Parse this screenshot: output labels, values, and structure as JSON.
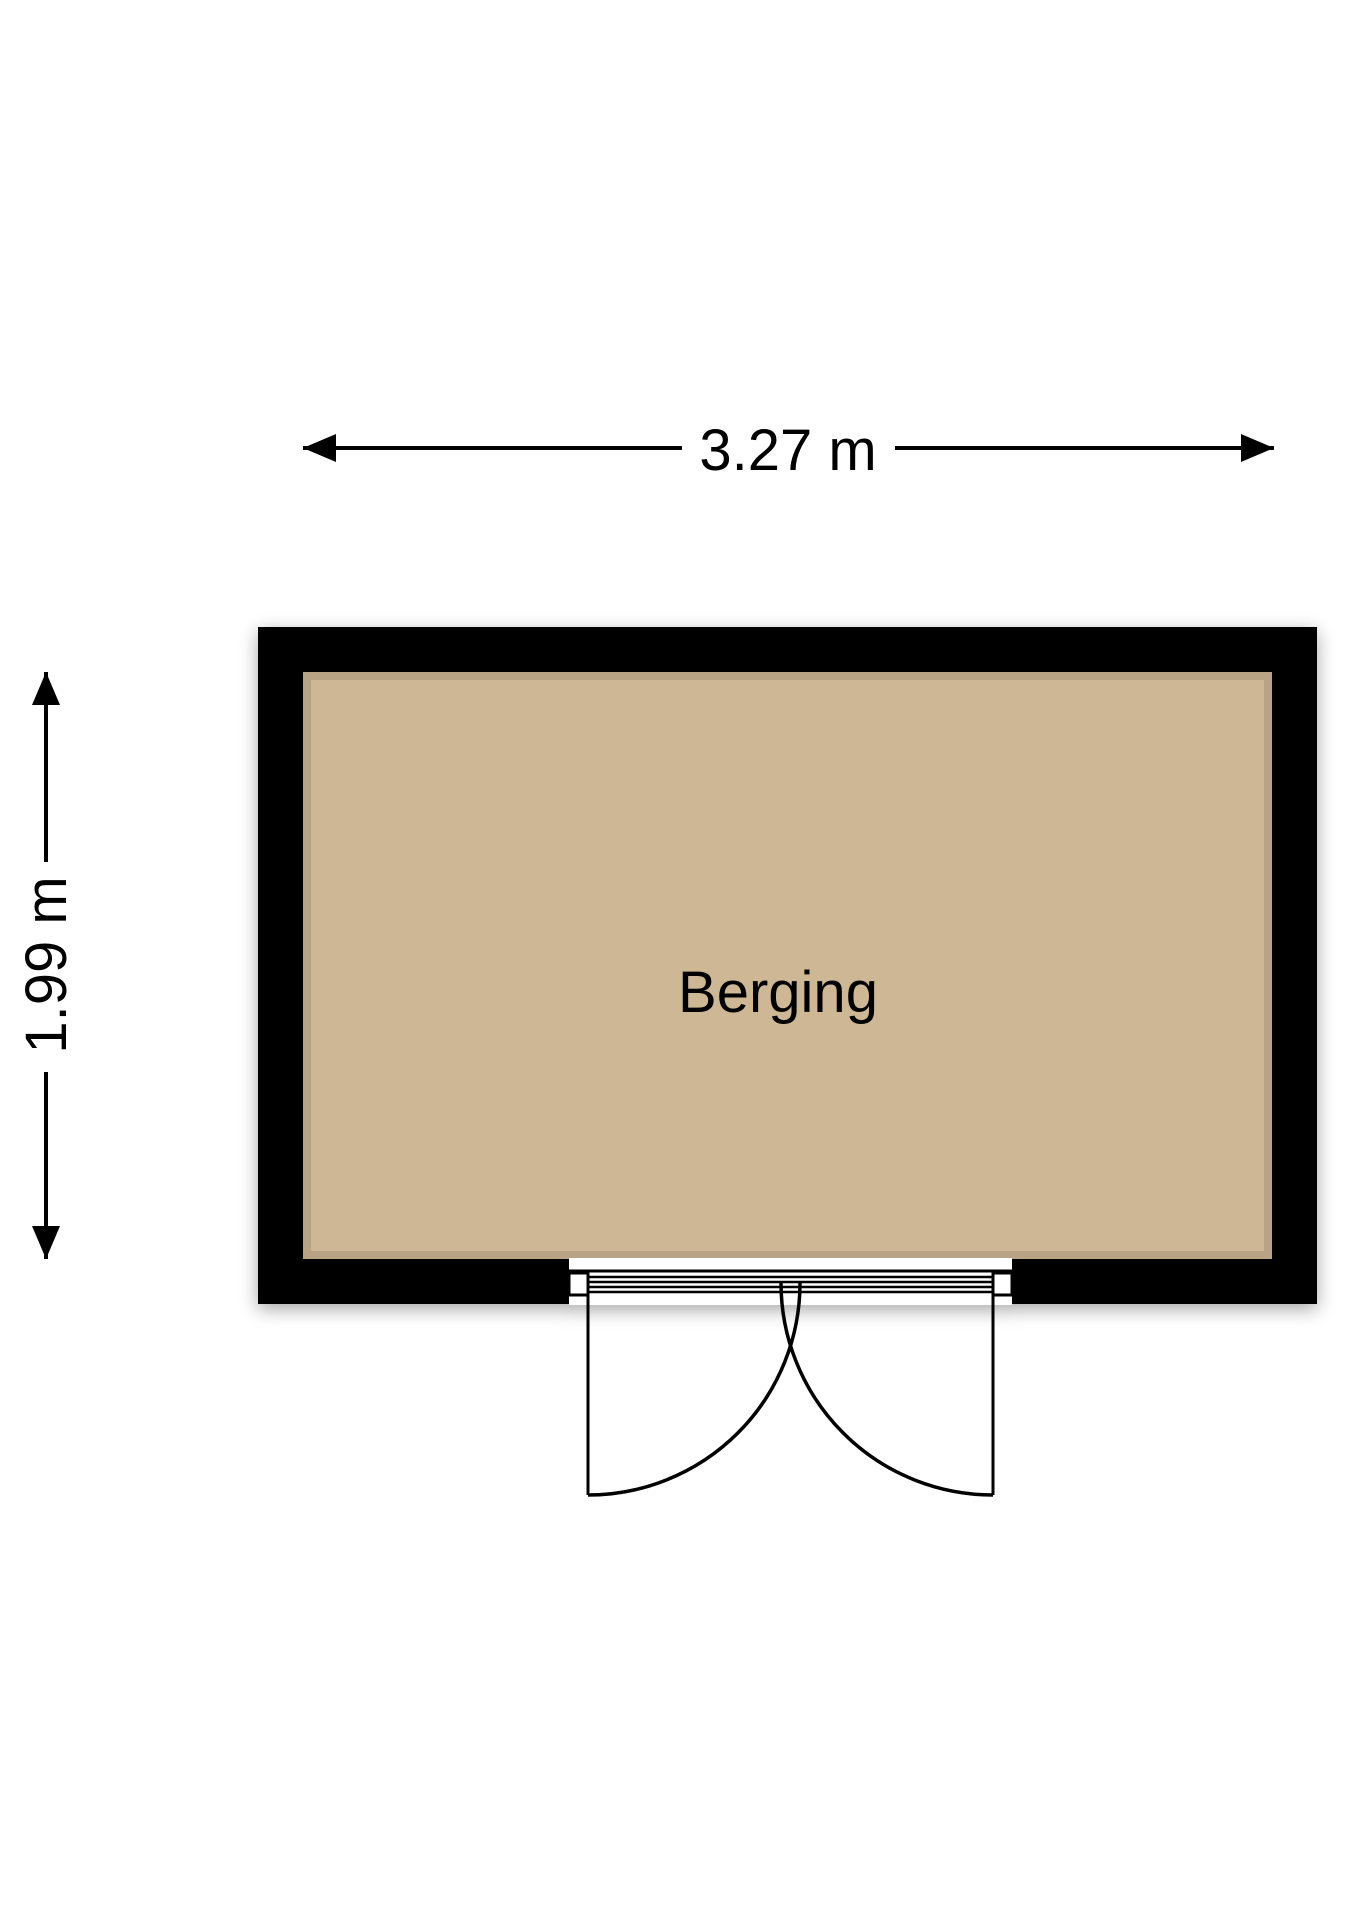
{
  "floorplan": {
    "room_label": "Berging",
    "width_dimension_label": "3.27 m",
    "height_dimension_label": "1.99 m",
    "colors": {
      "wall": "#000000",
      "floor": "#cdb795",
      "line": "#000000",
      "text": "#000000",
      "opening": "#ffffff",
      "background": "#ffffff"
    }
  }
}
